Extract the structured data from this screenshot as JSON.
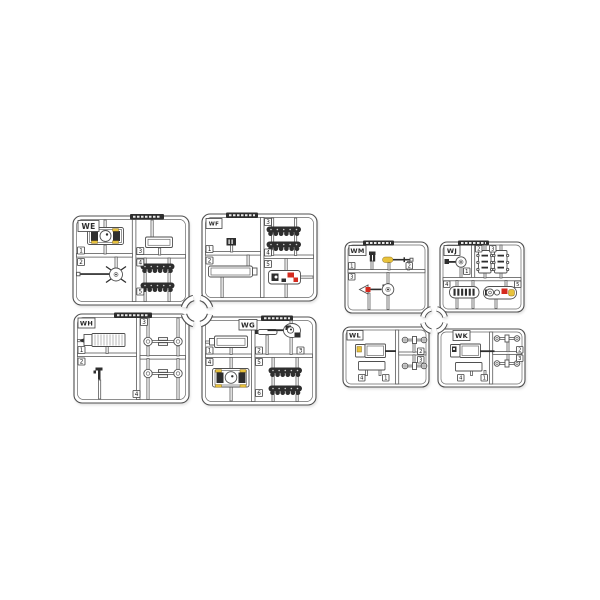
{
  "colors": {
    "background": "#ffffff",
    "outline": "#4f4f4f",
    "plastic_white": "#ffffff",
    "detail_dark": "#2e2e2e",
    "accent_yellow": "#e8c23b",
    "accent_red": "#d42a1e"
  },
  "sprues": {
    "we": {
      "label": "WE",
      "numbers": [
        "1",
        "2",
        "3",
        "4",
        "5"
      ]
    },
    "wf": {
      "label": "WF",
      "numbers": [
        "1",
        "2",
        "3",
        "4",
        "5"
      ]
    },
    "wh": {
      "label": "WH",
      "numbers": [
        "1",
        "2",
        "3",
        "4"
      ]
    },
    "wg": {
      "label": "WG",
      "numbers": [
        "1",
        "2",
        "3",
        "4",
        "5",
        "6"
      ]
    },
    "wm": {
      "label": "WM",
      "numbers": [
        "1",
        "2",
        "3"
      ]
    },
    "wj": {
      "label": "WJ",
      "numbers": [
        "1",
        "2",
        "3",
        "4",
        "5"
      ]
    },
    "wl": {
      "label": "WL",
      "numbers": [
        "1",
        "2",
        "3",
        "4"
      ]
    },
    "wk": {
      "label": "WK",
      "numbers": [
        "1",
        "2",
        "3",
        "4"
      ]
    }
  }
}
